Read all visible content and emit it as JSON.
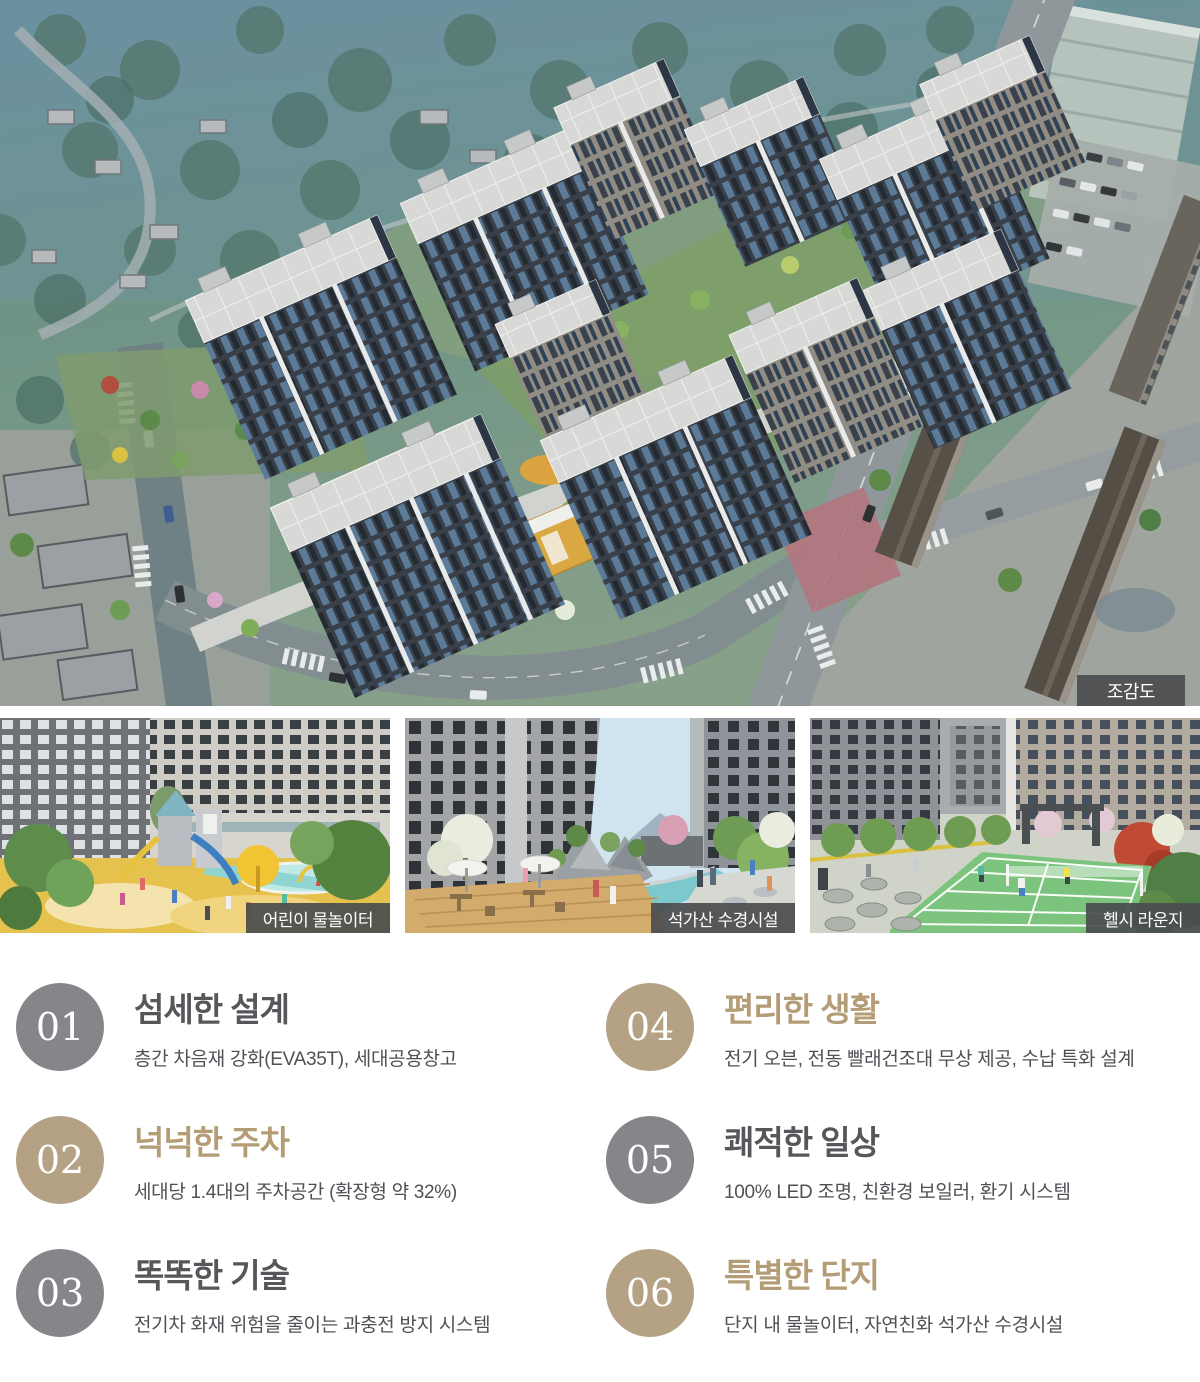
{
  "hero": {
    "badge_label": "조감도",
    "description": "아파트 단지 조감도 렌더링"
  },
  "thumbnails": [
    {
      "label": "어린이 물놀이터"
    },
    {
      "label": "석가산 수경시설"
    },
    {
      "label": "헬시 라운지"
    }
  ],
  "features": {
    "colors": {
      "gray_circle": "#84868a",
      "tan_circle": "#b5a184",
      "gray_title": "#55575b",
      "tan_title": "#b49d76",
      "desc_text": "#4f5156"
    },
    "items": [
      {
        "num": "01",
        "title": "섬세한 설계",
        "desc": "층간 차음재 강화(EVA35T), 세대공용창고",
        "theme": "gray"
      },
      {
        "num": "02",
        "title": "넉넉한 주차",
        "desc": "세대당 1.4대의 주차공간 (확장형 약 32%)",
        "theme": "tan"
      },
      {
        "num": "03",
        "title": "똑똑한 기술",
        "desc": "전기차 화재 위험을 줄이는 과충전 방지 시스템",
        "theme": "gray"
      },
      {
        "num": "04",
        "title": "편리한 생활",
        "desc": "전기 오븐, 전동 빨래건조대 무상 제공, 수납 특화 설계",
        "theme": "tan"
      },
      {
        "num": "05",
        "title": "쾌적한 일상",
        "desc": "100% LED 조명, 친환경 보일러, 환기 시스템",
        "theme": "gray"
      },
      {
        "num": "06",
        "title": "특별한 단지",
        "desc": "단지 내 물놀이터, 자연친화 석가산 수경시설",
        "theme": "tan"
      }
    ]
  }
}
